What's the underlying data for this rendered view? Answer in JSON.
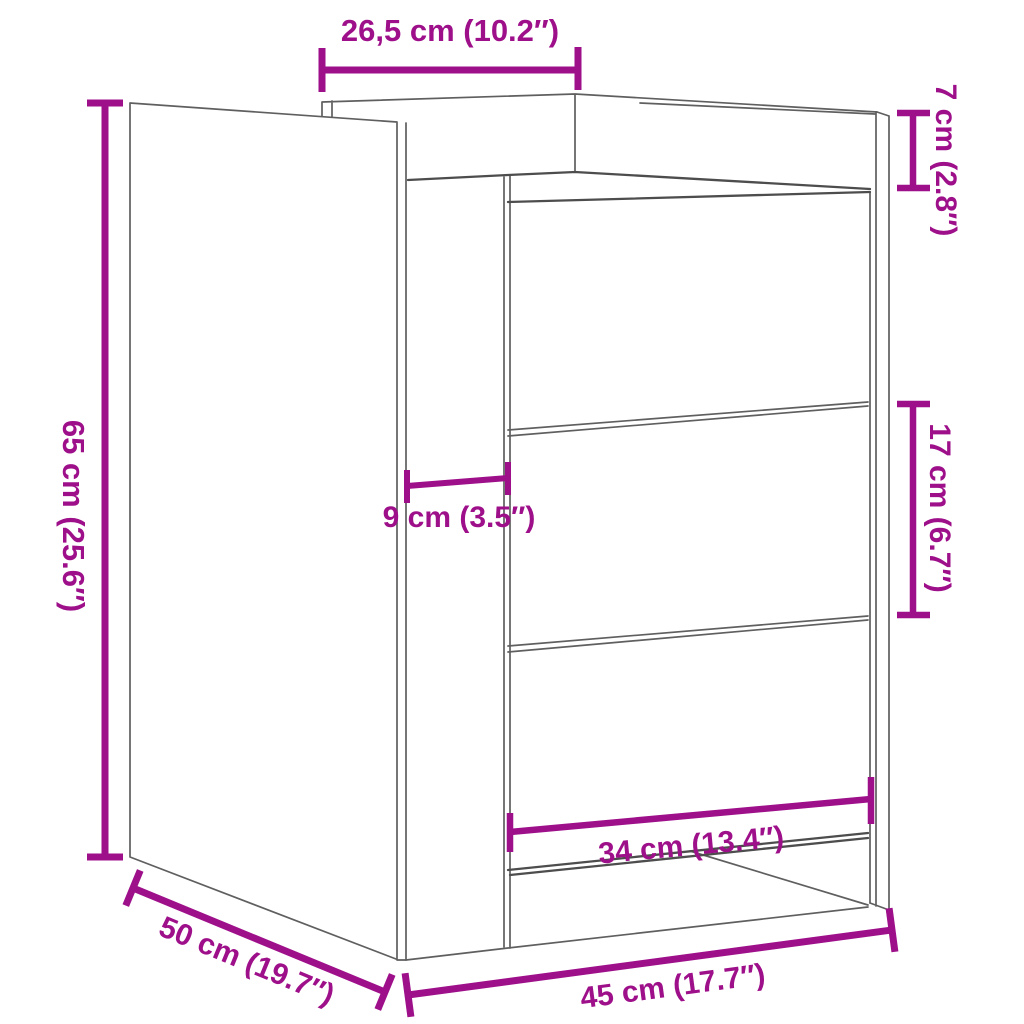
{
  "colors": {
    "accent": "#9e0f8a",
    "line_gray": "#5f5f5f",
    "line_dark": "#4d4d4d",
    "background": "#ffffff"
  },
  "dimensions": {
    "top_depth": {
      "label": "26,5 cm (10.2″)",
      "cm": "26,5",
      "inches": "10.2"
    },
    "back_height": {
      "label": "7 cm (2.8″)",
      "cm": "7",
      "inches": "2.8"
    },
    "height": {
      "label": "65 cm (25.6″)",
      "cm": "65",
      "inches": "25.6"
    },
    "left_inset": {
      "label": "9 cm (3.5″)",
      "cm": "9",
      "inches": "3.5"
    },
    "drawer_height": {
      "label": "17 cm (6.7″)",
      "cm": "17",
      "inches": "6.7"
    },
    "drawer_width": {
      "label": "34 cm (13.4″)",
      "cm": "34",
      "inches": "13.4"
    },
    "depth": {
      "label": "50 cm (19.7″)",
      "cm": "50",
      "inches": "19.7"
    },
    "width": {
      "label": "45 cm (17.7″)",
      "cm": "45",
      "inches": "17.7"
    }
  }
}
